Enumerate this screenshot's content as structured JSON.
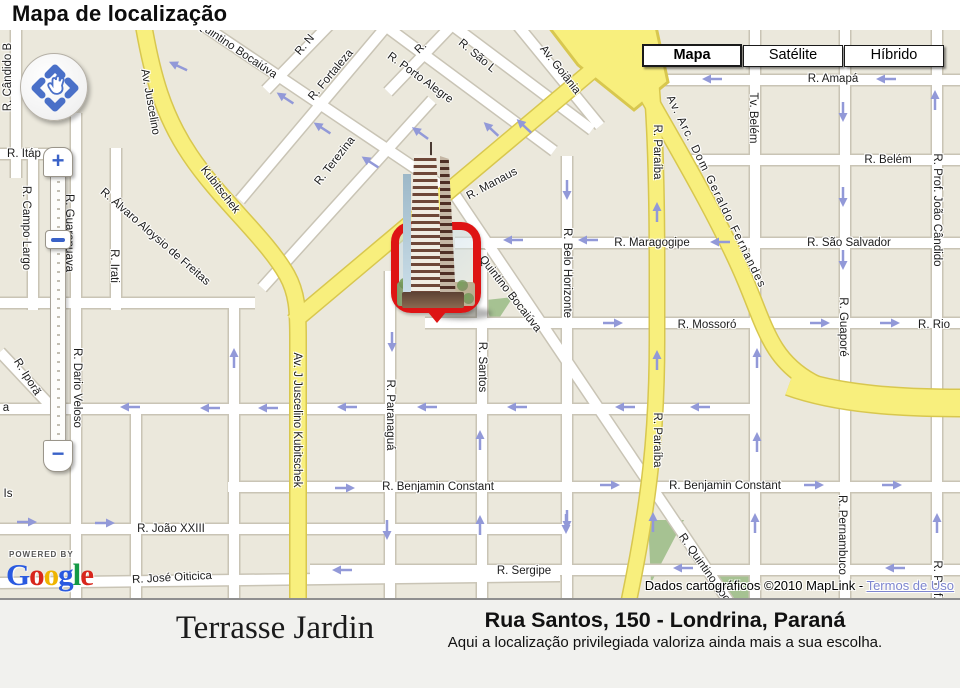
{
  "page": {
    "title": "Mapa de localização"
  },
  "map": {
    "controls": {
      "map_types": [
        {
          "label": "Mapa",
          "selected": true
        },
        {
          "label": "Satélite",
          "selected": false
        },
        {
          "label": "Híbrido",
          "selected": false
        }
      ],
      "zoom_in_label": "+",
      "zoom_out_label": "−"
    },
    "attribution": {
      "powered_by": "POWERED BY",
      "logo_letters": [
        {
          "ch": "G",
          "color": "#2a5ae0"
        },
        {
          "ch": "o",
          "color": "#d8261c"
        },
        {
          "ch": "o",
          "color": "#efb400"
        },
        {
          "ch": "g",
          "color": "#2a5ae0"
        },
        {
          "ch": "l",
          "color": "#159a46"
        },
        {
          "ch": "e",
          "color": "#d8261c"
        }
      ],
      "copyright": "Dados cartográficos ©2010 MapLink -",
      "terms_link": "Termos de Uso"
    },
    "colors": {
      "road_yellow": "#f8ef7d",
      "road_casing": "#d8c74f",
      "street_white": "#ffffff",
      "block": "#ebe8dc",
      "arrow": "#9299d8",
      "marker_red": "#de1414",
      "link_blue": "#7e86cf"
    },
    "street_labels": [
      {
        "text": "R. Cândido B",
        "x": 8,
        "y": 47,
        "r": -90
      },
      {
        "text": "R. Itáp",
        "x": 24,
        "y": 124,
        "r": 0
      },
      {
        "text": "R. Campo Largo",
        "x": 26,
        "y": 198,
        "r": 90
      },
      {
        "text": "R. Guarapuava",
        "x": 69,
        "y": 203,
        "r": 90
      },
      {
        "text": "R. Irati",
        "x": 114,
        "y": 236,
        "r": 90
      },
      {
        "text": "R. Álvaro Aloysio de Freitas",
        "x": 155,
        "y": 207,
        "r": 41
      },
      {
        "text": "Av. Juscelino",
        "x": 150,
        "y": 72,
        "r": 80
      },
      {
        "text": "Kubitschek",
        "x": 220,
        "y": 160,
        "r": 52
      },
      {
        "text": "Quintino Bocaiúva",
        "x": 237,
        "y": 20,
        "r": 34
      },
      {
        "text": "R. N",
        "x": 305,
        "y": 15,
        "r": -50
      },
      {
        "text": "R. Fortaleza",
        "x": 331,
        "y": 45,
        "r": -50
      },
      {
        "text": "R. Terezina",
        "x": 335,
        "y": 131,
        "r": -52
      },
      {
        "text": "R.",
        "x": 421,
        "y": 18,
        "r": -45
      },
      {
        "text": "R. Porto Alegre",
        "x": 420,
        "y": 48,
        "r": 36
      },
      {
        "text": "R. São L",
        "x": 477,
        "y": 26,
        "r": 40
      },
      {
        "text": "Av. Goiânia",
        "x": 560,
        "y": 40,
        "r": 52
      },
      {
        "text": "R. Manaus",
        "x": 492,
        "y": 154,
        "r": -28
      },
      {
        "text": "R. Amapá",
        "x": 833,
        "y": 49,
        "r": 0
      },
      {
        "text": "Tv. Belém",
        "x": 753,
        "y": 88,
        "r": 90
      },
      {
        "text": "R. Paraíba",
        "x": 657,
        "y": 122,
        "r": 90
      },
      {
        "text": "Av. Arc. Dom Geraldo Fernandes",
        "x": 716,
        "y": 162,
        "r": 64,
        "ls": 1.5
      },
      {
        "text": "R. Belém",
        "x": 888,
        "y": 130,
        "r": 0
      },
      {
        "text": "R. Prof. João Cândido",
        "x": 937,
        "y": 180,
        "r": 90
      },
      {
        "text": "R. Maragogipe",
        "x": 652,
        "y": 213,
        "r": 0
      },
      {
        "text": "R. São Salvador",
        "x": 849,
        "y": 213,
        "r": 0
      },
      {
        "text": "R. Belo Horizonte",
        "x": 567,
        "y": 243,
        "r": 90
      },
      {
        "text": "R. Guaporé",
        "x": 843,
        "y": 297,
        "r": 90
      },
      {
        "text": "R. Mossoró",
        "x": 707,
        "y": 295,
        "r": 0
      },
      {
        "text": "R. Rio",
        "x": 934,
        "y": 295,
        "r": 0
      },
      {
        "text": "Quintino Bocaiúva",
        "x": 510,
        "y": 264,
        "r": 52
      },
      {
        "text": "R. Santos",
        "x": 482,
        "y": 337,
        "r": 90
      },
      {
        "text": "R. Paranaguá",
        "x": 390,
        "y": 385,
        "r": 90
      },
      {
        "text": "Av. J Juscelino Kubitschek",
        "x": 297,
        "y": 390,
        "r": 90
      },
      {
        "text": "R. Dario Veloso",
        "x": 77,
        "y": 358,
        "r": 90
      },
      {
        "text": "R. Iporã",
        "x": 27,
        "y": 347,
        "r": 58
      },
      {
        "text": "a",
        "x": 6,
        "y": 378,
        "r": 0
      },
      {
        "text": "Is",
        "x": 8,
        "y": 464,
        "r": 0
      },
      {
        "text": "R. Paraíba",
        "x": 657,
        "y": 410,
        "r": 90
      },
      {
        "text": "R. Benjamin Constant",
        "x": 438,
        "y": 457,
        "r": 0
      },
      {
        "text": "R. Benjamin Constant",
        "x": 725,
        "y": 456,
        "r": 0
      },
      {
        "text": "R. Quintino Bocaiúva",
        "x": 712,
        "y": 549,
        "r": 55
      },
      {
        "text": "R. Pernambuco",
        "x": 842,
        "y": 505,
        "r": 90
      },
      {
        "text": "R. João XXIII",
        "x": 171,
        "y": 499,
        "r": 0
      },
      {
        "text": "R. José Oiticica",
        "x": 172,
        "y": 548,
        "r": -3
      },
      {
        "text": "R. Sergipe",
        "x": 524,
        "y": 541,
        "r": 0
      },
      {
        "text": "R. Prof. João Cândido",
        "x": 937,
        "y": 587,
        "r": 90
      }
    ],
    "arrows": [
      [
        178,
        36,
        205
      ],
      [
        285,
        68,
        213
      ],
      [
        322,
        98,
        213
      ],
      [
        370,
        132,
        213
      ],
      [
        420,
        103,
        216
      ],
      [
        491,
        99,
        223
      ],
      [
        524,
        96,
        223
      ],
      [
        712,
        49,
        180
      ],
      [
        886,
        49,
        180
      ],
      [
        843,
        82,
        90
      ],
      [
        935,
        70,
        270
      ],
      [
        843,
        167,
        90
      ],
      [
        513,
        210,
        180
      ],
      [
        588,
        210,
        180
      ],
      [
        720,
        212,
        180
      ],
      [
        843,
        230,
        90
      ],
      [
        657,
        182,
        270
      ],
      [
        567,
        160,
        90
      ],
      [
        613,
        293,
        0
      ],
      [
        820,
        293,
        0
      ],
      [
        890,
        293,
        0
      ],
      [
        657,
        330,
        270
      ],
      [
        757,
        328,
        270
      ],
      [
        757,
        412,
        270
      ],
      [
        130,
        377,
        180
      ],
      [
        210,
        378,
        180
      ],
      [
        268,
        378,
        180
      ],
      [
        347,
        377,
        180
      ],
      [
        427,
        377,
        180
      ],
      [
        517,
        377,
        180
      ],
      [
        625,
        377,
        180
      ],
      [
        700,
        377,
        180
      ],
      [
        392,
        312,
        90
      ],
      [
        480,
        410,
        270
      ],
      [
        234,
        328,
        270
      ],
      [
        27,
        492,
        0
      ],
      [
        105,
        493,
        0
      ],
      [
        345,
        458,
        0
      ],
      [
        610,
        455,
        0
      ],
      [
        814,
        455,
        0
      ],
      [
        892,
        455,
        0
      ],
      [
        567,
        490,
        90
      ],
      [
        653,
        492,
        270
      ],
      [
        755,
        493,
        270
      ],
      [
        937,
        493,
        270
      ],
      [
        342,
        540,
        180
      ],
      [
        683,
        538,
        180
      ],
      [
        895,
        538,
        180
      ],
      [
        387,
        500,
        90
      ],
      [
        480,
        495,
        270
      ],
      [
        566,
        494,
        90
      ]
    ]
  },
  "footer": {
    "building_name": "Terrasse Jardin",
    "address": "Rua Santos, 150 - Londrina, Paraná",
    "tagline": "Aqui a localização privilegiada valoriza ainda mais a sua escolha."
  }
}
